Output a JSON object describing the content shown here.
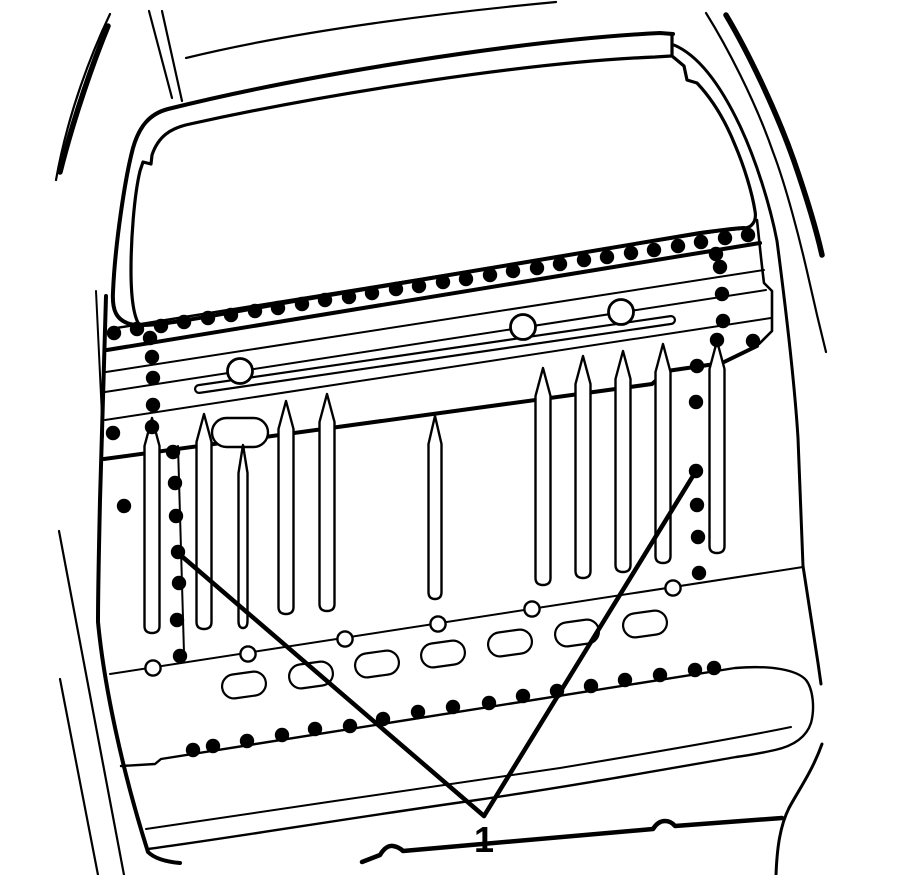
{
  "figure": {
    "background_color": "#ffffff",
    "line_color": "#000000",
    "callout": {
      "label": "1",
      "font_size": 36,
      "label_x": 484,
      "label_y": 852,
      "apex": [
        484,
        816
      ],
      "targets": [
        [
          178,
          553
        ],
        [
          696,
          471
        ]
      ],
      "stroke_width": 4.5
    },
    "weld_dots": {
      "radius": 7.2,
      "top_row": [
        [
          114,
          333
        ],
        [
          137,
          329
        ],
        [
          161,
          326
        ],
        [
          184,
          322
        ],
        [
          208,
          318
        ],
        [
          231,
          315
        ],
        [
          255,
          311
        ],
        [
          278,
          308
        ],
        [
          302,
          304
        ],
        [
          325,
          300
        ],
        [
          349,
          297
        ],
        [
          372,
          293
        ],
        [
          396,
          289
        ],
        [
          419,
          286
        ],
        [
          443,
          282
        ],
        [
          466,
          279
        ],
        [
          490,
          275
        ],
        [
          513,
          271
        ],
        [
          537,
          268
        ],
        [
          560,
          264
        ],
        [
          584,
          260
        ],
        [
          607,
          257
        ],
        [
          631,
          253
        ],
        [
          654,
          250
        ],
        [
          678,
          246
        ],
        [
          701,
          242
        ],
        [
          725,
          238
        ],
        [
          748,
          235
        ]
      ],
      "left_column": [
        [
          150,
          338
        ],
        [
          152,
          357
        ],
        [
          153,
          378
        ],
        [
          153,
          405
        ],
        [
          152,
          427
        ],
        [
          173,
          452
        ],
        [
          175,
          483
        ],
        [
          176,
          516
        ],
        [
          178,
          552
        ],
        [
          179,
          583
        ],
        [
          177,
          620
        ],
        [
          180,
          656
        ]
      ],
      "right_column": [
        [
          716,
          254
        ],
        [
          720,
          267
        ],
        [
          722,
          294
        ],
        [
          723,
          321
        ],
        [
          717,
          340
        ],
        [
          753,
          341
        ],
        [
          697,
          366
        ],
        [
          696,
          402
        ],
        [
          696,
          471
        ],
        [
          697,
          505
        ],
        [
          698,
          537
        ],
        [
          699,
          573
        ]
      ],
      "lower_row": [
        [
          193,
          750
        ],
        [
          213,
          746
        ],
        [
          247,
          741
        ],
        [
          282,
          735
        ],
        [
          315,
          729
        ],
        [
          350,
          726
        ],
        [
          383,
          719
        ],
        [
          418,
          712
        ],
        [
          453,
          707
        ],
        [
          489,
          703
        ],
        [
          523,
          696
        ],
        [
          557,
          691
        ],
        [
          591,
          686
        ],
        [
          625,
          680
        ],
        [
          660,
          675
        ],
        [
          695,
          670
        ],
        [
          714,
          668
        ]
      ],
      "extra": [
        [
          124,
          506
        ],
        [
          113,
          433
        ]
      ]
    },
    "open_circles": {
      "large": {
        "radius": 12.5,
        "stroke_width": 2.8,
        "points": [
          [
            240,
            371
          ],
          [
            523,
            327
          ],
          [
            621,
            312
          ]
        ]
      },
      "small": {
        "radius": 7.6,
        "stroke_width": 2.4,
        "points": [
          [
            153,
            668
          ],
          [
            248,
            654
          ],
          [
            345,
            639
          ],
          [
            438,
            624
          ],
          [
            532,
            609
          ],
          [
            673,
            588
          ]
        ]
      }
    },
    "slots": {
      "ovals": {
        "width": 44,
        "height": 24,
        "stroke_width": 2.2,
        "centers": [
          [
            244,
            685
          ],
          [
            311,
            675
          ],
          [
            377,
            664
          ],
          [
            443,
            654
          ],
          [
            510,
            643
          ],
          [
            577,
            633
          ],
          [
            645,
            624
          ]
        ]
      },
      "capsule": {
        "x": 212,
        "y": 418,
        "width": 56,
        "height": 29,
        "stroke_width": 2.4
      },
      "rod": {
        "x1": 199,
        "y1": 389,
        "x2": 671,
        "y2": 320,
        "outer_width": 10,
        "inner_width": 5.6
      }
    },
    "ribs": {
      "stroke_width": 2.4,
      "items": [
        [
          152,
          418,
          633,
          15
        ],
        [
          204,
          414,
          629,
          15
        ],
        [
          243,
          445,
          628,
          9
        ],
        [
          286,
          401,
          614,
          15
        ],
        [
          327,
          394,
          611,
          15
        ],
        [
          435,
          416,
          599,
          13
        ],
        [
          543,
          368,
          585,
          15
        ],
        [
          583,
          356,
          578,
          15
        ],
        [
          623,
          351,
          572,
          15
        ],
        [
          663,
          344,
          563,
          15
        ],
        [
          717,
          341,
          553,
          15
        ]
      ]
    }
  }
}
